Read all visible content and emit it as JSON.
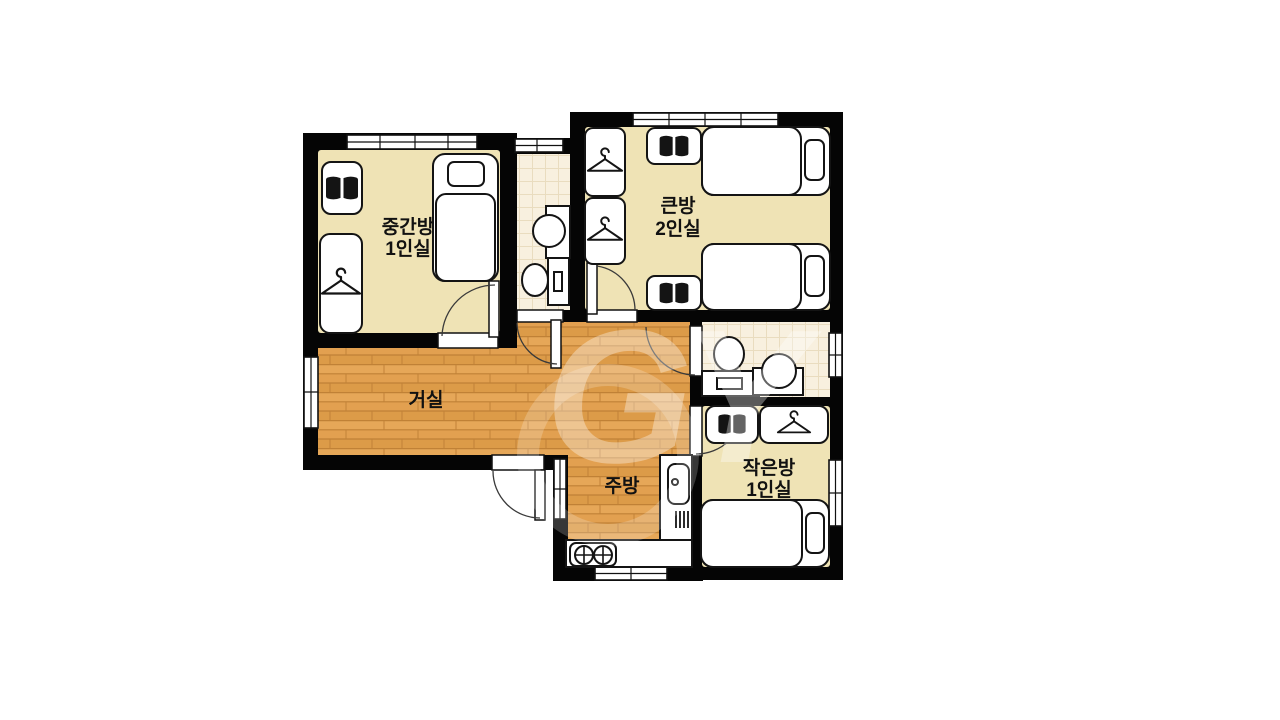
{
  "watermark": {
    "text": "GY"
  },
  "rooms": {
    "middle": {
      "name": "중간방",
      "capacity": "1인실"
    },
    "big": {
      "name": "큰방",
      "capacity": "2인실"
    },
    "living": {
      "name": "거실"
    },
    "kitchen": {
      "name": "주방"
    },
    "small": {
      "name": "작은방",
      "capacity": "1인실"
    }
  },
  "colors": {
    "wall": "#050505",
    "bedroom_floor": "#efe3b5",
    "wood_floor": "#e2a050",
    "tile_floor": "#f8f0df",
    "furniture": "#ffffff",
    "outline": "#141414",
    "icon": "#141414",
    "label": "#111111",
    "watermark": "#ffffff",
    "background": "#ffffff"
  }
}
